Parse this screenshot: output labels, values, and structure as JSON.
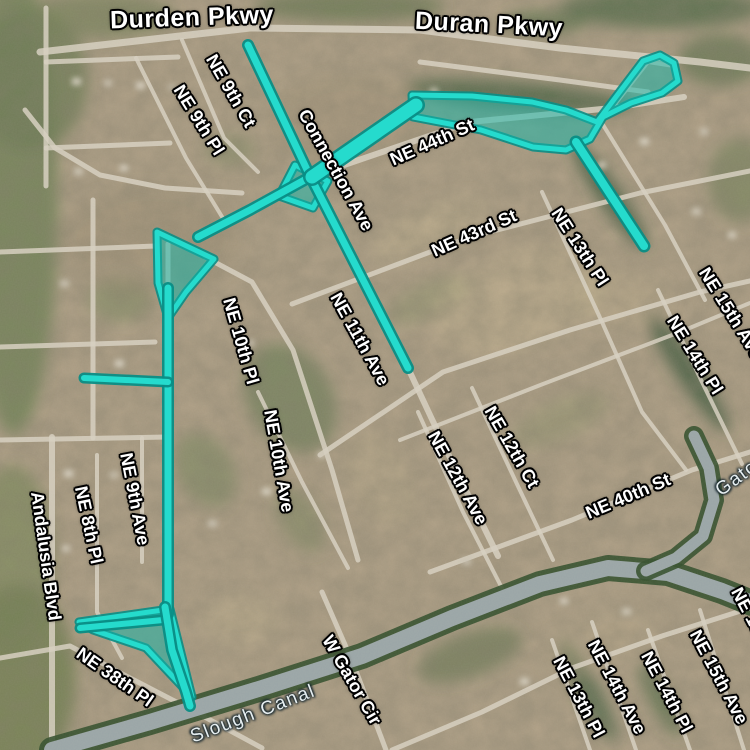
{
  "map": {
    "view": "satellite",
    "description": "Aerial satellite view of a residential grid subdivision with a teal highlighted route/waterway overlay"
  },
  "colors": {
    "ground": "#b2a288",
    "road": "#d6cfbf",
    "route": "#25dbcd",
    "route_casing": "#0a8d85",
    "route_fill": "#14b7ab",
    "canal_water": "#9aa5a6",
    "canal_bank": "#36512f",
    "label_text": "#ffffff",
    "water_label_text": "#e6eef0"
  },
  "labels": [
    {
      "text": "Durden Pkwy",
      "x": 192,
      "y": 18,
      "rot": -2,
      "kind": "parkway"
    },
    {
      "text": "Duran Pkwy",
      "x": 489,
      "y": 25,
      "rot": 3,
      "kind": "parkway"
    },
    {
      "text": "NE 9th Ct",
      "x": 231,
      "y": 91,
      "rot": 60,
      "kind": "street"
    },
    {
      "text": "NE 9th Pl",
      "x": 199,
      "y": 120,
      "rot": 58,
      "kind": "street"
    },
    {
      "text": "Connection Ave",
      "x": 336,
      "y": 170,
      "rot": 61,
      "kind": "street"
    },
    {
      "text": "NE 44th St",
      "x": 432,
      "y": 142,
      "rot": -24,
      "kind": "street"
    },
    {
      "text": "NE 43rd St",
      "x": 474,
      "y": 233,
      "rot": -24,
      "kind": "street"
    },
    {
      "text": "NE 13th Pl",
      "x": 580,
      "y": 247,
      "rot": 57,
      "kind": "street"
    },
    {
      "text": "NE 15th Ave",
      "x": 731,
      "y": 313,
      "rot": 58,
      "kind": "street"
    },
    {
      "text": "NE 14th Pl",
      "x": 695,
      "y": 355,
      "rot": 58,
      "kind": "street"
    },
    {
      "text": "NE 10th Pl",
      "x": 241,
      "y": 341,
      "rot": 74,
      "kind": "street"
    },
    {
      "text": "NE 11th Ave",
      "x": 360,
      "y": 339,
      "rot": 61,
      "kind": "street"
    },
    {
      "text": "NE 10th Ave",
      "x": 279,
      "y": 461,
      "rot": 80,
      "kind": "street"
    },
    {
      "text": "NE 12th Ave",
      "x": 458,
      "y": 478,
      "rot": 61,
      "kind": "street"
    },
    {
      "text": "NE 12th Ct",
      "x": 512,
      "y": 447,
      "rot": 60,
      "kind": "street"
    },
    {
      "text": "NE 40th St",
      "x": 628,
      "y": 496,
      "rot": -23,
      "kind": "street"
    },
    {
      "text": "Andalusia Blvd",
      "x": 46,
      "y": 556,
      "rot": 82,
      "kind": "street"
    },
    {
      "text": "NE 8th Pl",
      "x": 89,
      "y": 525,
      "rot": 78,
      "kind": "street"
    },
    {
      "text": "NE 9th Ave",
      "x": 135,
      "y": 499,
      "rot": 79,
      "kind": "street"
    },
    {
      "text": "NE 38th Pl",
      "x": 115,
      "y": 677,
      "rot": 35,
      "kind": "street"
    },
    {
      "text": "W Gator Cir",
      "x": 352,
      "y": 680,
      "rot": 60,
      "kind": "street"
    },
    {
      "text": "NE 13th Pl",
      "x": 579,
      "y": 697,
      "rot": 62,
      "kind": "street"
    },
    {
      "text": "NE 14th Ave",
      "x": 617,
      "y": 687,
      "rot": 62,
      "kind": "street"
    },
    {
      "text": "NE 14th Pl",
      "x": 667,
      "y": 692,
      "rot": 62,
      "kind": "street"
    },
    {
      "text": "NE 15th Ave",
      "x": 719,
      "y": 677,
      "rot": 62,
      "kind": "street"
    },
    {
      "text": "NE 15th Pl",
      "x": 757,
      "y": 628,
      "rot": 62,
      "kind": "street"
    },
    {
      "text": "Slough Canal",
      "x": 253,
      "y": 714,
      "rot": -21,
      "kind": "water"
    },
    {
      "text": "Gator",
      "x": 740,
      "y": 476,
      "rot": -36,
      "kind": "water"
    }
  ],
  "route_overlay": {
    "lines": [
      {
        "pts": [
          [
            248,
            45
          ],
          [
            310,
            176
          ],
          [
            408,
            368
          ]
        ],
        "w": 7
      },
      {
        "pts": [
          [
            310,
            177
          ],
          [
            250,
            210
          ],
          [
            198,
            237
          ]
        ],
        "w": 7
      },
      {
        "pts": [
          [
            168,
            288
          ],
          [
            168,
            614
          ]
        ],
        "w": 7
      },
      {
        "pts": [
          [
            84,
            378
          ],
          [
            168,
            382
          ]
        ],
        "w": 6
      },
      {
        "pts": [
          [
            80,
            628
          ],
          [
            163,
            620
          ]
        ],
        "w": 6
      },
      {
        "pts": [
          [
            165,
            607
          ],
          [
            172,
            650
          ],
          [
            186,
            692
          ],
          [
            190,
            706
          ]
        ],
        "w": 7
      },
      {
        "pts": [
          [
            312,
            177
          ],
          [
            416,
            105
          ]
        ],
        "w": 13
      },
      {
        "pts": [
          [
            576,
            142
          ],
          [
            644,
            246
          ]
        ],
        "w": 8
      }
    ],
    "polygons": [
      {
        "pts": [
          [
            412,
            95
          ],
          [
            472,
            96
          ],
          [
            532,
            102
          ],
          [
            566,
            110
          ],
          [
            597,
            122
          ],
          [
            643,
            61
          ],
          [
            660,
            55
          ],
          [
            674,
            63
          ],
          [
            678,
            81
          ],
          [
            662,
            93
          ],
          [
            631,
            103
          ],
          [
            603,
            117
          ],
          [
            590,
            139
          ],
          [
            566,
            150
          ],
          [
            533,
            147
          ],
          [
            481,
            130
          ],
          [
            413,
            117
          ]
        ]
      },
      {
        "pts": [
          [
            295,
            165
          ],
          [
            328,
            181
          ],
          [
            313,
            208
          ],
          [
            279,
            196
          ]
        ]
      },
      {
        "pts": [
          [
            157,
            232
          ],
          [
            214,
            259
          ],
          [
            186,
            292
          ],
          [
            168,
            318
          ],
          [
            158,
            283
          ]
        ]
      },
      {
        "pts": [
          [
            79,
            622
          ],
          [
            170,
            609
          ],
          [
            192,
            697
          ],
          [
            146,
            648
          ],
          [
            93,
            630
          ]
        ]
      }
    ]
  },
  "roads": [
    {
      "pts": [
        [
          40,
          52
        ],
        [
          250,
          28
        ],
        [
          420,
          30
        ],
        [
          560,
          48
        ],
        [
          700,
          62
        ],
        [
          750,
          68
        ]
      ],
      "w": 7
    },
    {
      "pts": [
        [
          420,
          62
        ],
        [
          560,
          80
        ],
        [
          648,
          92
        ]
      ],
      "w": 5
    },
    {
      "pts": [
        [
          46,
          8
        ],
        [
          46,
          186
        ]
      ],
      "w": 5
    },
    {
      "pts": [
        [
          46,
          62
        ],
        [
          178,
          57
        ]
      ],
      "w": 5
    },
    {
      "pts": [
        [
          46,
          148
        ],
        [
          170,
          143
        ]
      ],
      "w": 5
    },
    {
      "pts": [
        [
          25,
          110
        ],
        [
          55,
          148
        ],
        [
          100,
          175
        ],
        [
          165,
          188
        ],
        [
          242,
          193
        ]
      ],
      "w": 5
    },
    {
      "pts": [
        [
          93,
          200
        ],
        [
          93,
          438
        ]
      ],
      "w": 5
    },
    {
      "pts": [
        [
          0,
          252
        ],
        [
          156,
          246
        ]
      ],
      "w": 5
    },
    {
      "pts": [
        [
          0,
          347
        ],
        [
          155,
          342
        ]
      ],
      "w": 5
    },
    {
      "pts": [
        [
          0,
          440
        ],
        [
          168,
          437
        ]
      ],
      "w": 5
    },
    {
      "pts": [
        [
          142,
          438
        ],
        [
          142,
          562
        ]
      ],
      "w": 4
    },
    {
      "pts": [
        [
          52,
          437
        ],
        [
          52,
          750
        ]
      ],
      "w": 6
    },
    {
      "pts": [
        [
          97,
          455
        ],
        [
          97,
          612
        ],
        [
          122,
          658
        ]
      ],
      "w": 4
    },
    {
      "pts": [
        [
          168,
          244
        ],
        [
          168,
          642
        ]
      ],
      "w": 5
    },
    {
      "pts": [
        [
          0,
          658
        ],
        [
          70,
          646
        ],
        [
          130,
          678
        ],
        [
          188,
          708
        ],
        [
          262,
          748
        ]
      ],
      "w": 5
    },
    {
      "pts": [
        [
          205,
          257
        ],
        [
          252,
          282
        ],
        [
          293,
          350
        ],
        [
          332,
          470
        ],
        [
          358,
          560
        ]
      ],
      "w": 5
    },
    {
      "pts": [
        [
          258,
          392
        ],
        [
          302,
          482
        ],
        [
          348,
          568
        ]
      ],
      "w": 4
    },
    {
      "pts": [
        [
          248,
          45
        ],
        [
          310,
          176
        ],
        [
          408,
          368
        ],
        [
          452,
          462
        ],
        [
          498,
          556
        ]
      ],
      "w": 6
    },
    {
      "pts": [
        [
          182,
          40
        ],
        [
          224,
          138
        ],
        [
          258,
          172
        ]
      ],
      "w": 4
    },
    {
      "pts": [
        [
          136,
          58
        ],
        [
          186,
          158
        ],
        [
          224,
          220
        ]
      ],
      "w": 4
    },
    {
      "pts": [
        [
          312,
          176
        ],
        [
          470,
          122
        ],
        [
          612,
          108
        ],
        [
          684,
          97
        ]
      ],
      "w": 6
    },
    {
      "pts": [
        [
          292,
          304
        ],
        [
          470,
          237
        ],
        [
          640,
          193
        ],
        [
          750,
          171
        ]
      ],
      "w": 5
    },
    {
      "pts": [
        [
          320,
          455
        ],
        [
          443,
          372
        ],
        [
          570,
          330
        ],
        [
          700,
          292
        ],
        [
          750,
          281
        ]
      ],
      "w": 5
    },
    {
      "pts": [
        [
          400,
          440
        ],
        [
          543,
          384
        ],
        [
          680,
          332
        ],
        [
          750,
          303
        ]
      ],
      "w": 4
    },
    {
      "pts": [
        [
          430,
          572
        ],
        [
          572,
          520
        ],
        [
          692,
          470
        ],
        [
          750,
          452
        ]
      ],
      "w": 5
    },
    {
      "pts": [
        [
          542,
          192
        ],
        [
          602,
          322
        ],
        [
          642,
          412
        ],
        [
          686,
          470
        ]
      ],
      "w": 4
    },
    {
      "pts": [
        [
          658,
          290
        ],
        [
          702,
          382
        ],
        [
          742,
          464
        ]
      ],
      "w": 4
    },
    {
      "pts": [
        [
          418,
          412
        ],
        [
          463,
          512
        ],
        [
          506,
          596
        ]
      ],
      "w": 4
    },
    {
      "pts": [
        [
          472,
          388
        ],
        [
          516,
          482
        ],
        [
          553,
          560
        ]
      ],
      "w": 4
    },
    {
      "pts": [
        [
          322,
          592
        ],
        [
          353,
          663
        ],
        [
          386,
          750
        ]
      ],
      "w": 5
    },
    {
      "pts": [
        [
          392,
          750
        ],
        [
          482,
          712
        ],
        [
          572,
          668
        ],
        [
          662,
          636
        ],
        [
          750,
          608
        ]
      ],
      "w": 5
    },
    {
      "pts": [
        [
          552,
          640
        ],
        [
          590,
          750
        ]
      ],
      "w": 4
    },
    {
      "pts": [
        [
          592,
          622
        ],
        [
          636,
          750
        ]
      ],
      "w": 4
    },
    {
      "pts": [
        [
          648,
          630
        ],
        [
          690,
          750
        ]
      ],
      "w": 4
    },
    {
      "pts": [
        [
          700,
          610
        ],
        [
          744,
          750
        ]
      ],
      "w": 4
    },
    {
      "pts": [
        [
          612,
          108
        ],
        [
          648,
          62
        ],
        [
          674,
          66
        ]
      ],
      "w": 4
    },
    {
      "pts": [
        [
          600,
          120
        ],
        [
          665,
          225
        ],
        [
          705,
          300
        ]
      ],
      "w": 4
    }
  ],
  "canal": {
    "main": [
      [
        52,
        750
      ],
      [
        150,
        722
      ],
      [
        262,
        688
      ],
      [
        362,
        656
      ],
      [
        452,
        618
      ],
      [
        540,
        584
      ],
      [
        608,
        568
      ],
      [
        668,
        573
      ],
      [
        722,
        591
      ],
      [
        752,
        603
      ]
    ],
    "branch": [
      [
        694,
        436
      ],
      [
        709,
        468
      ],
      [
        714,
        500
      ],
      [
        703,
        536
      ],
      [
        676,
        558
      ],
      [
        646,
        571
      ]
    ]
  }
}
